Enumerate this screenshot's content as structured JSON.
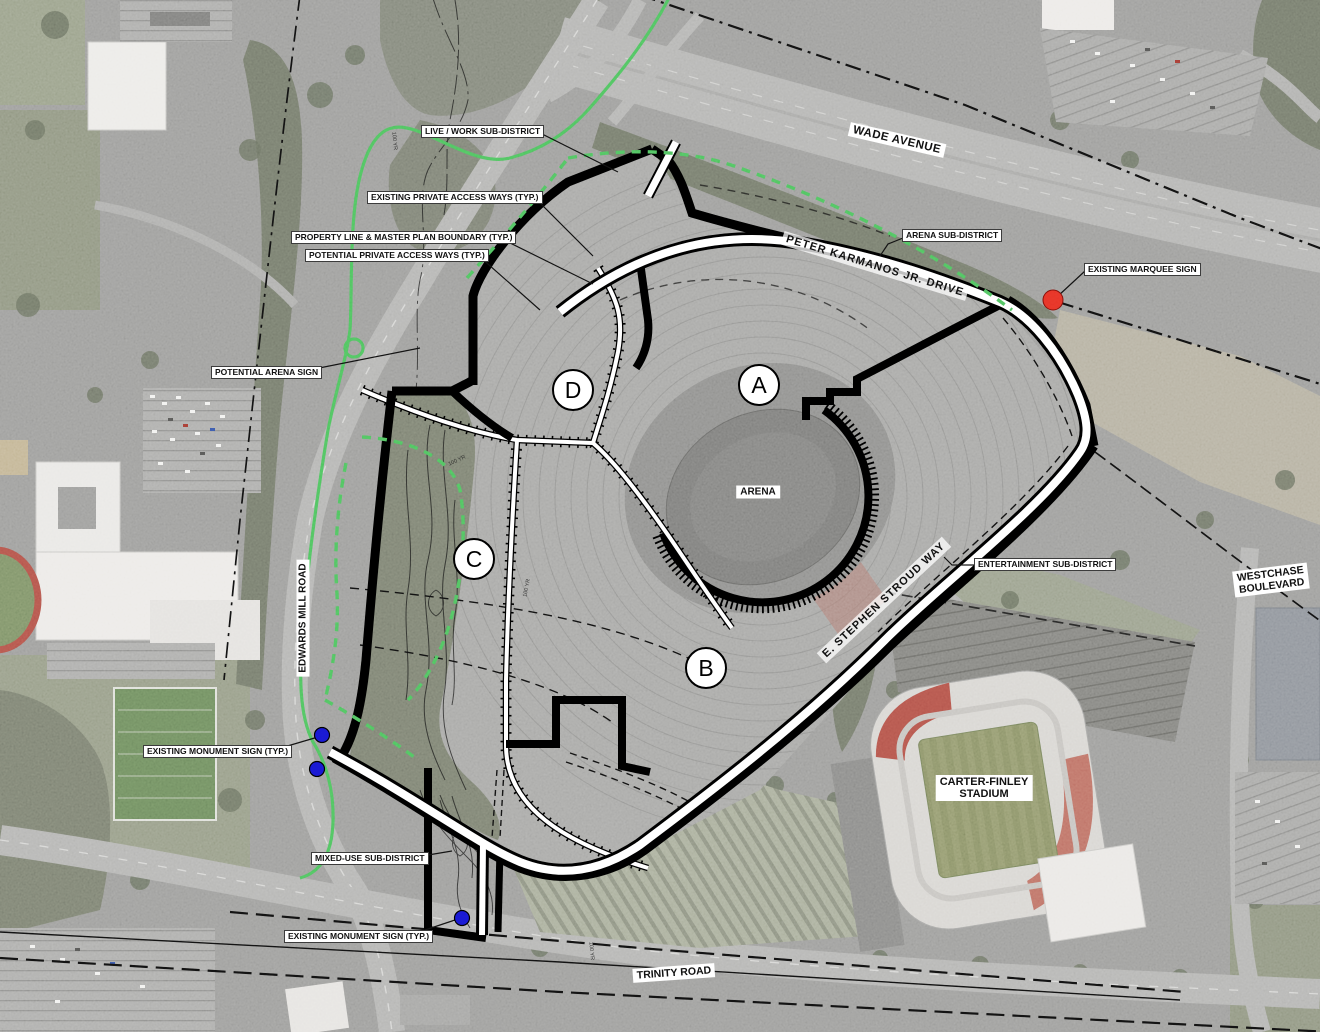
{
  "map": {
    "callouts": {
      "live_work": "LIVE / WORK SUB-DISTRICT",
      "existing_access": "EXISTING PRIVATE ACCESS WAYS (TYP.)",
      "property_line": "PROPERTY LINE & MASTER PLAN BOUNDARY (TYP.)",
      "potential_access": "POTENTIAL PRIVATE ACCESS WAYS (TYP.)",
      "potential_arena_sign": "POTENTIAL ARENA SIGN",
      "arena_subdistrict": "ARENA SUB-DISTRICT",
      "existing_marquee_sign": "EXISTING MARQUEE SIGN",
      "entertainment_subdistrict": "ENTERTAINMENT SUB-DISTRICT",
      "existing_monument_sign": "EXISTING MONUMENT SIGN (TYP.)",
      "mixed_use_subdistrict": "MIXED-USE SUB-DISTRICT",
      "existing_monument_sign_2": "EXISTING MONUMENT SIGN (TYP.)"
    },
    "roads": {
      "wade": "WADE AVENUE",
      "peter_karmanos": "PETER KARMANOS JR. DRIVE",
      "stroud": "E. STEPHEN STROUD WAY",
      "edwards_mill": "EDWARDS MILL ROAD",
      "trinity": "TRINITY ROAD",
      "westchase": [
        "WESTCHASE",
        "BOULEVARD"
      ]
    },
    "places": {
      "arena": "ARENA",
      "carter_finley": [
        "CARTER-FINLEY",
        "STADIUM"
      ]
    },
    "parcels": [
      "A",
      "B",
      "C",
      "D"
    ],
    "flood_label": "100 YR",
    "markers": {
      "marquee_sign_color": "#e53226",
      "monument_sign_color": "#1717cf",
      "monument_sign_count": 3
    },
    "colors": {
      "greenway": "#4ec15d",
      "boundary": "#000000",
      "marquee_red": "#e53226",
      "monument_blue": "#1717cf",
      "label_bg": "#ffffff"
    }
  }
}
